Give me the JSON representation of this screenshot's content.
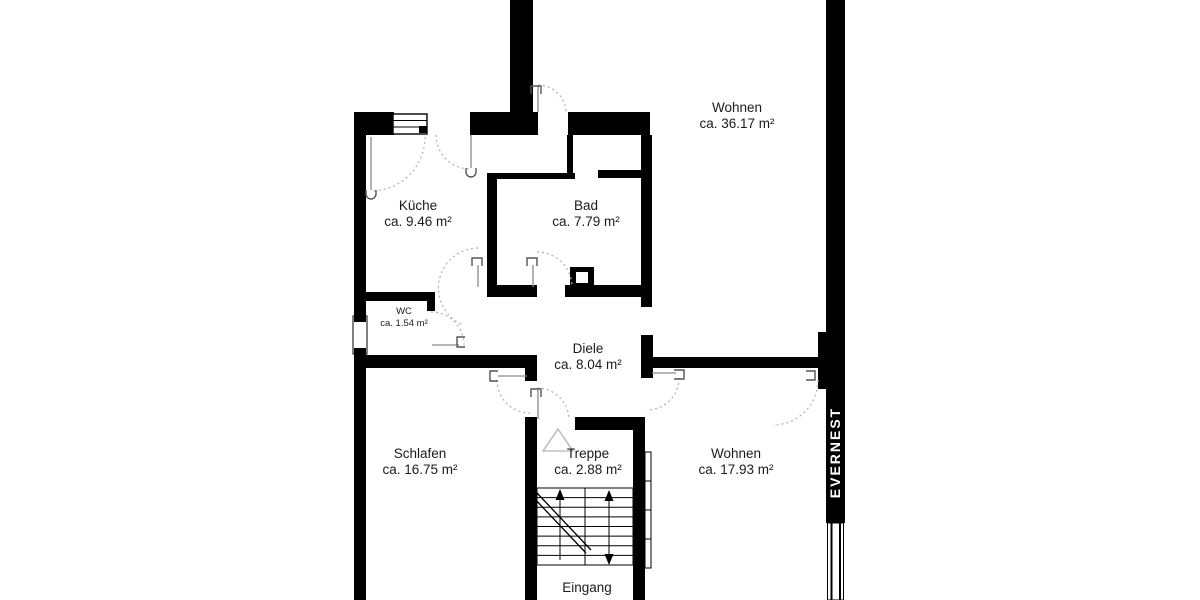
{
  "plan": {
    "background": "#ffffff",
    "wall_color": "#000000",
    "door_arc_color": "#b5b5b5",
    "watermark": "EVERNEST",
    "entrance_label": "Eingang",
    "rooms": [
      {
        "id": "wohnen-oben",
        "name": "Wohnen",
        "area": "ca. 36.17 m²"
      },
      {
        "id": "kueche",
        "name": "Küche",
        "area": "ca. 9.46 m²"
      },
      {
        "id": "bad",
        "name": "Bad",
        "area": "ca. 7.79 m²"
      },
      {
        "id": "wc",
        "name": "WC",
        "area": "ca. 1.54 m²"
      },
      {
        "id": "diele",
        "name": "Diele",
        "area": "ca. 8.04 m²"
      },
      {
        "id": "schlafen",
        "name": "Schlafen",
        "area": "ca. 16.75 m²"
      },
      {
        "id": "treppe",
        "name": "Treppe",
        "area": "ca. 2.88 m²"
      },
      {
        "id": "wohnen-unten",
        "name": "Wohnen",
        "area": "ca. 17.93 m²"
      }
    ]
  }
}
